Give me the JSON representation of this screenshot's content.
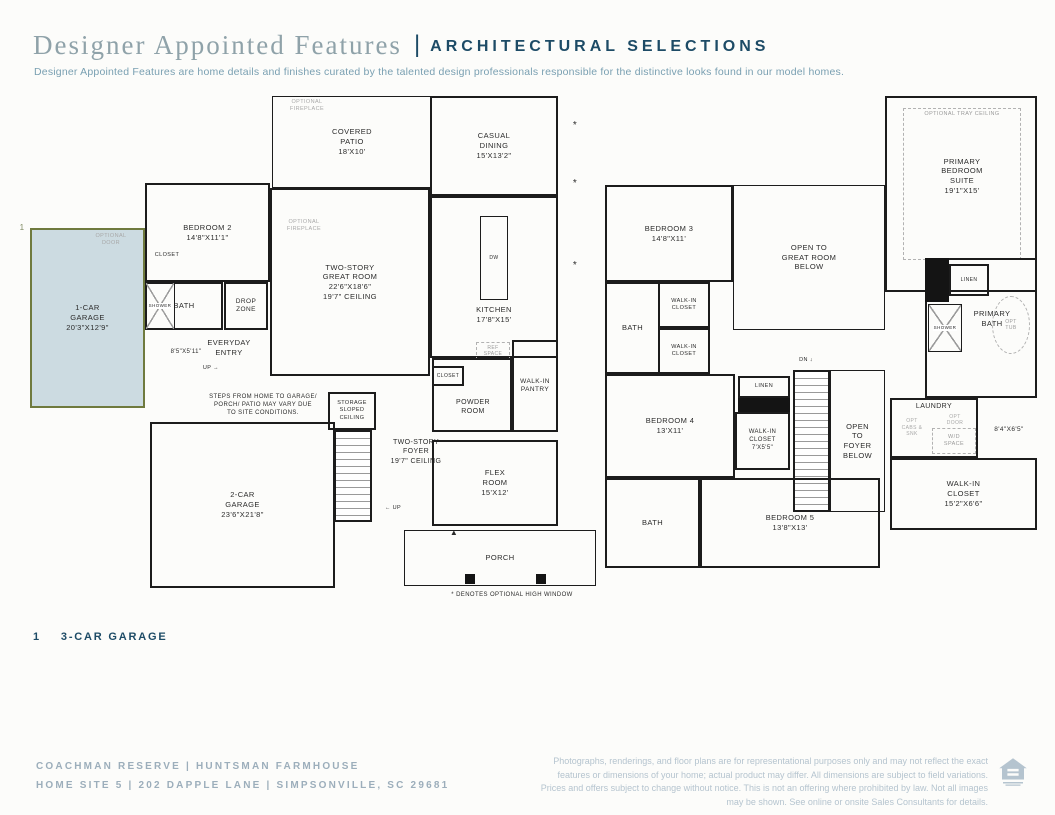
{
  "colors": {
    "accent_navy": "#1d4b66",
    "title_gray": "#8fa2a9",
    "subtitle_blue": "#7aa0b2",
    "highlight_fill": "#ccdbe1",
    "highlight_border": "#6f7a3e",
    "footer_gray": "#9caebb",
    "disclaimer_gray": "#b5c4cf"
  },
  "header": {
    "title": "Designer Appointed Features",
    "divider": "|",
    "caps": "ARCHITECTURAL SELECTIONS",
    "subtitle": "Designer Appointed Features are home details and finishes curated by the talented design professionals responsible for the distinctive looks found in our model homes."
  },
  "callout": {
    "number": "1",
    "label": "3-CAR GARAGE"
  },
  "footer": {
    "community_line": "COACHMAN RESERVE   |   HUNTSMAN FARMHOUSE",
    "address_line": "HOME SITE 5   |   202 DAPPLE LANE   |   SIMPSONVILLE, SC 29681",
    "disclaimer": "Photographs, renderings, and floor plans are for representational purposes only and may not reflect the exact features or dimensions of your home; actual product may differ. All dimensions are subject to field variations. Prices and offers subject to change without notice. This is not an offering where prohibited by law. Not all images may be shown. See online or onsite Sales Consultants for details.",
    "equal_housing_icon": "equal-housing-logo"
  },
  "floor1": {
    "rooms": [
      {
        "id": "covered-patio",
        "type": "room-thin",
        "x": 244,
        "y": 4,
        "w": 160,
        "h": 92,
        "label": "COVERED\nPATIO\n18'X10'"
      },
      {
        "id": "optional-fireplace-patio",
        "type": "gray-label",
        "x": 248,
        "y": 6,
        "w": 62,
        "h": 16,
        "label": "OPTIONAL\nFIREPLACE",
        "fs": 5.5
      },
      {
        "id": "casual-dining",
        "type": "room",
        "x": 402,
        "y": 4,
        "w": 128,
        "h": 100,
        "label": "CASUAL\nDINING\n15'X13'2\""
      },
      {
        "id": "great-room",
        "type": "room",
        "x": 242,
        "y": 96,
        "w": 160,
        "h": 188,
        "label": "TWO-STORY\nGREAT ROOM\n22'6\"X18'6\"\n19'7\" CEILING"
      },
      {
        "id": "optional-fireplace-greatroom",
        "type": "gray-label",
        "x": 246,
        "y": 126,
        "w": 60,
        "h": 16,
        "label": "OPTIONAL\nFIREPLACE",
        "fs": 5.5
      },
      {
        "id": "kitchen",
        "type": "room",
        "x": 402,
        "y": 104,
        "w": 128,
        "h": 162,
        "label": ""
      },
      {
        "id": "kitchen-island",
        "type": "room-thin",
        "x": 452,
        "y": 124,
        "w": 28,
        "h": 84,
        "label": "DW",
        "fs": 5
      },
      {
        "id": "kitchen-label",
        "type": "label",
        "x": 414,
        "y": 212,
        "w": 104,
        "h": 22,
        "label": "KITCHEN\n17'8\"X15'"
      },
      {
        "id": "ref-space",
        "type": "dashed",
        "x": 448,
        "y": 250,
        "w": 34,
        "h": 18,
        "label": "REF\nSPACE",
        "fs": 5
      },
      {
        "id": "bedroom-2",
        "type": "room",
        "x": 117,
        "y": 91,
        "w": 125,
        "h": 99,
        "label": "BEDROOM 2\n14'8\"X11'1\""
      },
      {
        "id": "bedroom2-closet",
        "type": "label",
        "x": 118,
        "y": 158,
        "w": 42,
        "h": 12,
        "label": "CLOSET",
        "fs": 5.5
      },
      {
        "id": "bath-1",
        "type": "room",
        "x": 117,
        "y": 190,
        "w": 78,
        "h": 48,
        "label": "BATH"
      },
      {
        "id": "shower-1",
        "type": "shower",
        "x": 117,
        "y": 190,
        "w": 30,
        "h": 48,
        "label": "SHOWER",
        "fs": 4.5
      },
      {
        "id": "garage-1",
        "type": "highlight",
        "x": 2,
        "y": 136,
        "w": 115,
        "h": 180,
        "label": "1-CAR\nGARAGE\n20'3\"X12'9\""
      },
      {
        "id": "garage1-optional-door",
        "type": "gray-label",
        "x": 52,
        "y": 140,
        "w": 62,
        "h": 16,
        "label": "OPTIONAL\nDOOR",
        "fs": 5.5
      },
      {
        "id": "callout-marker-1",
        "type": "label",
        "x": -12,
        "y": 130,
        "w": 12,
        "h": 12,
        "label": "1",
        "fs": 8,
        "color": "#7f8a63"
      },
      {
        "id": "drop-zone",
        "type": "room",
        "x": 196,
        "y": 190,
        "w": 44,
        "h": 48,
        "label": "DROP\nZONE",
        "fs": 6.5
      },
      {
        "id": "everyday-entry",
        "type": "label",
        "x": 160,
        "y": 243,
        "w": 82,
        "h": 26,
        "label": "EVERYDAY\nENTRY",
        "fs": 7.5
      },
      {
        "id": "entry-dim",
        "type": "label",
        "x": 128,
        "y": 256,
        "w": 60,
        "h": 10,
        "label": "8'5\"X5'11\"",
        "fs": 6
      },
      {
        "id": "entry-up",
        "type": "label",
        "x": 166,
        "y": 272,
        "w": 34,
        "h": 10,
        "label": "UP →",
        "fs": 5.5
      },
      {
        "id": "steps-note",
        "type": "label",
        "x": 158,
        "y": 298,
        "w": 154,
        "h": 32,
        "label": "STEPS FROM HOME TO GARAGE/\nPORCH/ PATIO MAY VARY DUE\nTO SITE CONDITIONS.",
        "fs": 6
      },
      {
        "id": "storage",
        "type": "room",
        "x": 300,
        "y": 300,
        "w": 48,
        "h": 38,
        "label": "STORAGE\nSLOPED\nCEILING",
        "fs": 5.5
      },
      {
        "id": "stairs-1",
        "type": "stairs",
        "x": 306,
        "y": 338,
        "w": 38,
        "h": 92,
        "label": ""
      },
      {
        "id": "foyer-label",
        "type": "label",
        "x": 344,
        "y": 342,
        "w": 88,
        "h": 36,
        "label": "TWO-STORY\nFOYER\n19'7\" CEILING",
        "fs": 7
      },
      {
        "id": "foyer-up",
        "type": "label",
        "x": 348,
        "y": 412,
        "w": 34,
        "h": 10,
        "label": "← UP",
        "fs": 5.5
      },
      {
        "id": "front-door-marker",
        "type": "label",
        "x": 420,
        "y": 436,
        "w": 12,
        "h": 10,
        "label": "▲",
        "fs": 8
      },
      {
        "id": "garage-2",
        "type": "room",
        "x": 122,
        "y": 330,
        "w": 185,
        "h": 166,
        "label": "2-CAR\nGARAGE\n23'6\"X21'8\""
      },
      {
        "id": "powder-room",
        "type": "room",
        "x": 404,
        "y": 266,
        "w": 80,
        "h": 74,
        "label": ""
      },
      {
        "id": "closet-powder",
        "type": "room",
        "x": 404,
        "y": 274,
        "w": 32,
        "h": 20,
        "label": "CLOSET",
        "fs": 5
      },
      {
        "id": "powder-label",
        "type": "label",
        "x": 414,
        "y": 304,
        "w": 62,
        "h": 22,
        "label": "POWDER\nROOM",
        "fs": 7
      },
      {
        "id": "pantry",
        "type": "room",
        "x": 484,
        "y": 248,
        "w": 46,
        "h": 92,
        "label": "WALK-IN\nPANTRY",
        "fs": 6.5
      },
      {
        "id": "flex-room",
        "type": "room",
        "x": 404,
        "y": 348,
        "w": 126,
        "h": 86,
        "label": "FLEX\nROOM\n15'X12'"
      },
      {
        "id": "porch",
        "type": "room-thin",
        "x": 376,
        "y": 438,
        "w": 192,
        "h": 56,
        "label": "PORCH"
      },
      {
        "id": "porch-post-1",
        "type": "black",
        "x": 437,
        "y": 482,
        "w": 10,
        "h": 10,
        "label": ""
      },
      {
        "id": "porch-post-2",
        "type": "black",
        "x": 508,
        "y": 482,
        "w": 10,
        "h": 10,
        "label": ""
      },
      {
        "id": "high-window-asterisk-1",
        "type": "label",
        "x": 542,
        "y": 28,
        "w": 10,
        "h": 10,
        "label": "*",
        "fs": 10
      },
      {
        "id": "high-window-asterisk-2",
        "type": "label",
        "x": 542,
        "y": 86,
        "w": 10,
        "h": 10,
        "label": "*",
        "fs": 10
      },
      {
        "id": "high-window-asterisk-3",
        "type": "label",
        "x": 542,
        "y": 168,
        "w": 10,
        "h": 10,
        "label": "*",
        "fs": 10
      },
      {
        "id": "high-window-footnote",
        "type": "label",
        "x": 398,
        "y": 498,
        "w": 172,
        "h": 12,
        "label": "* DENOTES OPTIONAL HIGH WINDOW",
        "fs": 6
      }
    ]
  },
  "floor2": {
    "rooms": [
      {
        "id": "primary-suite",
        "type": "room",
        "x": 285,
        "y": 4,
        "w": 152,
        "h": 196,
        "label": ""
      },
      {
        "id": "tray-ceiling",
        "type": "dashed",
        "x": 303,
        "y": 16,
        "w": 118,
        "h": 152,
        "label": "OPTIONAL TRAY CEILING",
        "fs": 5.5,
        "align": "top"
      },
      {
        "id": "primary-suite-label",
        "type": "label",
        "x": 317,
        "y": 58,
        "w": 90,
        "h": 52,
        "label": "PRIMARY\nBEDROOM\nSUITE\n19'1\"X15'"
      },
      {
        "id": "bedroom-3",
        "type": "room",
        "x": 5,
        "y": 93,
        "w": 128,
        "h": 97,
        "label": "BEDROOM 3\n14'8\"X11'"
      },
      {
        "id": "open-great-room",
        "type": "room-thin",
        "x": 133,
        "y": 93,
        "w": 152,
        "h": 145,
        "label": "OPEN TO\nGREAT ROOM\nBELOW"
      },
      {
        "id": "bath-2",
        "type": "room",
        "x": 5,
        "y": 190,
        "w": 55,
        "h": 92,
        "label": "BATH"
      },
      {
        "id": "wic-bedroom3",
        "type": "room",
        "x": 58,
        "y": 190,
        "w": 52,
        "h": 46,
        "label": "WALK-IN\nCLOSET",
        "fs": 5.5
      },
      {
        "id": "wic-bedroom4",
        "type": "room",
        "x": 58,
        "y": 236,
        "w": 52,
        "h": 46,
        "label": "WALK-IN\nCLOSET",
        "fs": 5.5
      },
      {
        "id": "bedroom-4",
        "type": "room",
        "x": 5,
        "y": 282,
        "w": 130,
        "h": 104,
        "label": "BEDROOM 4\n13'X11'"
      },
      {
        "id": "linen-hall",
        "type": "room",
        "x": 138,
        "y": 284,
        "w": 52,
        "h": 22,
        "label": "LINEN",
        "fs": 5.5
      },
      {
        "id": "linen-wall-fill",
        "type": "black",
        "x": 138,
        "y": 306,
        "w": 52,
        "h": 14,
        "label": ""
      },
      {
        "id": "wic-7x55",
        "type": "room",
        "x": 135,
        "y": 320,
        "w": 55,
        "h": 58,
        "label": "WALK-IN\nCLOSET\n7'X5'5\"",
        "fs": 6
      },
      {
        "id": "stairs-2",
        "type": "stairs",
        "x": 193,
        "y": 278,
        "w": 37,
        "h": 142,
        "label": ""
      },
      {
        "id": "stairs2-dn",
        "type": "label",
        "x": 191,
        "y": 264,
        "w": 30,
        "h": 10,
        "label": "DN ↓",
        "fs": 5.5
      },
      {
        "id": "open-foyer",
        "type": "room-thin",
        "x": 230,
        "y": 278,
        "w": 55,
        "h": 142,
        "label": "OPEN\nTO\nFOYER\nBELOW"
      },
      {
        "id": "primary-bath",
        "type": "room",
        "x": 325,
        "y": 166,
        "w": 112,
        "h": 140,
        "label": ""
      },
      {
        "id": "linen-primary-fill",
        "type": "black",
        "x": 325,
        "y": 166,
        "w": 24,
        "h": 44,
        "label": ""
      },
      {
        "id": "linen-primary",
        "type": "room",
        "x": 349,
        "y": 172,
        "w": 40,
        "h": 32,
        "label": "LINEN",
        "fs": 5
      },
      {
        "id": "primary-bath-label",
        "type": "label",
        "x": 352,
        "y": 214,
        "w": 80,
        "h": 26,
        "label": "PRIMARY\nBATH"
      },
      {
        "id": "shower-primary",
        "type": "shower",
        "x": 328,
        "y": 212,
        "w": 34,
        "h": 48,
        "label": "SHOWER",
        "fs": 4.5
      },
      {
        "id": "opt-tub",
        "type": "oval",
        "x": 392,
        "y": 204,
        "w": 38,
        "h": 58,
        "label": "OPT\nTUB",
        "fs": 5
      },
      {
        "id": "laundry",
        "type": "room",
        "x": 290,
        "y": 306,
        "w": 88,
        "h": 60,
        "label": ""
      },
      {
        "id": "laundry-label",
        "type": "label",
        "x": 298,
        "y": 309,
        "w": 72,
        "h": 12,
        "label": "LAUNDRY",
        "fs": 7
      },
      {
        "id": "laundry-opt-cabs",
        "type": "gray-label",
        "x": 292,
        "y": 322,
        "w": 40,
        "h": 28,
        "label": "OPT\nCABS &\nSNK",
        "fs": 5
      },
      {
        "id": "laundry-opt-door",
        "type": "gray-label",
        "x": 334,
        "y": 322,
        "w": 42,
        "h": 12,
        "label": "OPT\nDOOR",
        "fs": 5
      },
      {
        "id": "wd-space",
        "type": "dashed",
        "x": 332,
        "y": 336,
        "w": 44,
        "h": 26,
        "label": "W/D\nSPACE",
        "fs": 5.5
      },
      {
        "id": "hall-dim",
        "type": "label",
        "x": 380,
        "y": 332,
        "w": 58,
        "h": 12,
        "label": "8'4\"X6'5\"",
        "fs": 6.5
      },
      {
        "id": "wic-primary",
        "type": "room",
        "x": 290,
        "y": 366,
        "w": 147,
        "h": 72,
        "label": "WALK-IN\nCLOSET\n15'2\"X6'6\""
      },
      {
        "id": "bedroom-5",
        "type": "room",
        "x": 100,
        "y": 386,
        "w": 180,
        "h": 90,
        "label": "BEDROOM 5\n13'8\"X13'"
      },
      {
        "id": "bath-3",
        "type": "room",
        "x": 5,
        "y": 386,
        "w": 95,
        "h": 90,
        "label": "BATH"
      }
    ]
  }
}
